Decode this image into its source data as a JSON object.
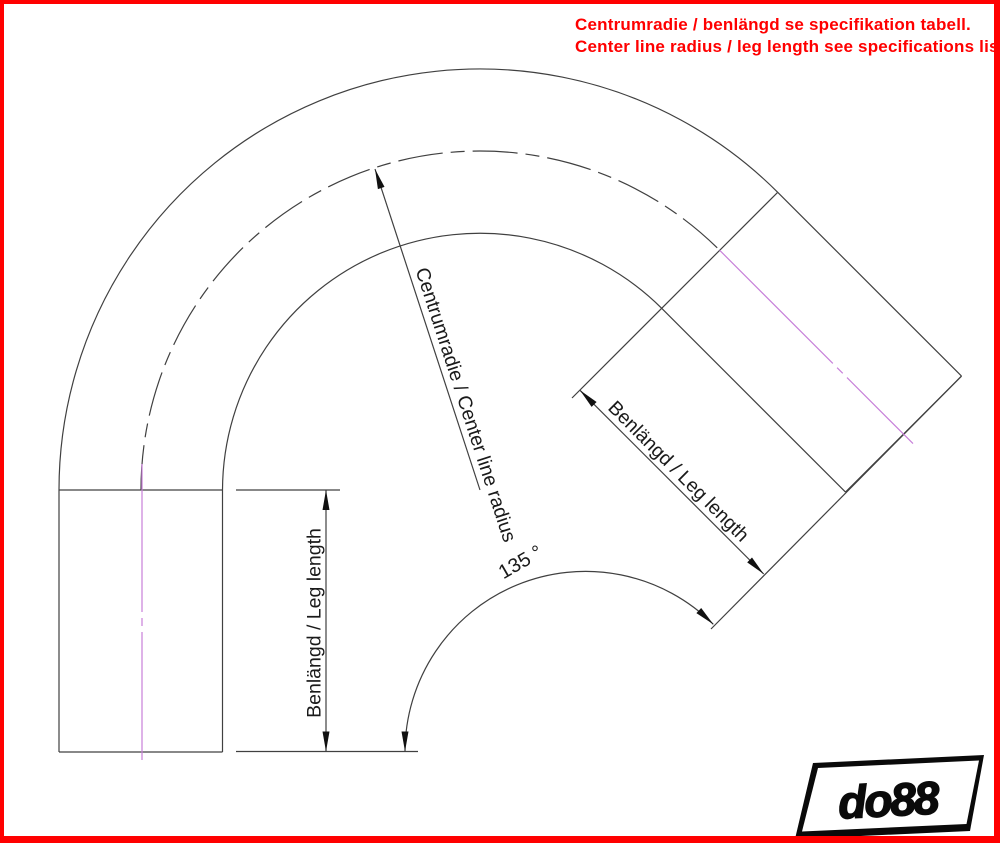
{
  "header": {
    "note_lines": [
      "Centrumradie / benlängd se specifikation tabell.",
      "Center line radius / leg length see specifications list."
    ]
  },
  "diagram": {
    "type": "technical-drawing",
    "subject": "135 degree elbow with two straight legs",
    "center_radius_label": "Centrumradie / Center line radius",
    "left_leg_label": "Benlängd / Leg length",
    "right_leg_label": "Benlängd / Leg length",
    "angle_label": "135 °",
    "bend_angle_deg": 135
  },
  "logo": {
    "text": "do88"
  },
  "colors": {
    "accent_red": "#FF0000",
    "centerline_magenta": "#C77FD9",
    "drawing_line": "#404040",
    "arrow_fill": "#111111"
  }
}
